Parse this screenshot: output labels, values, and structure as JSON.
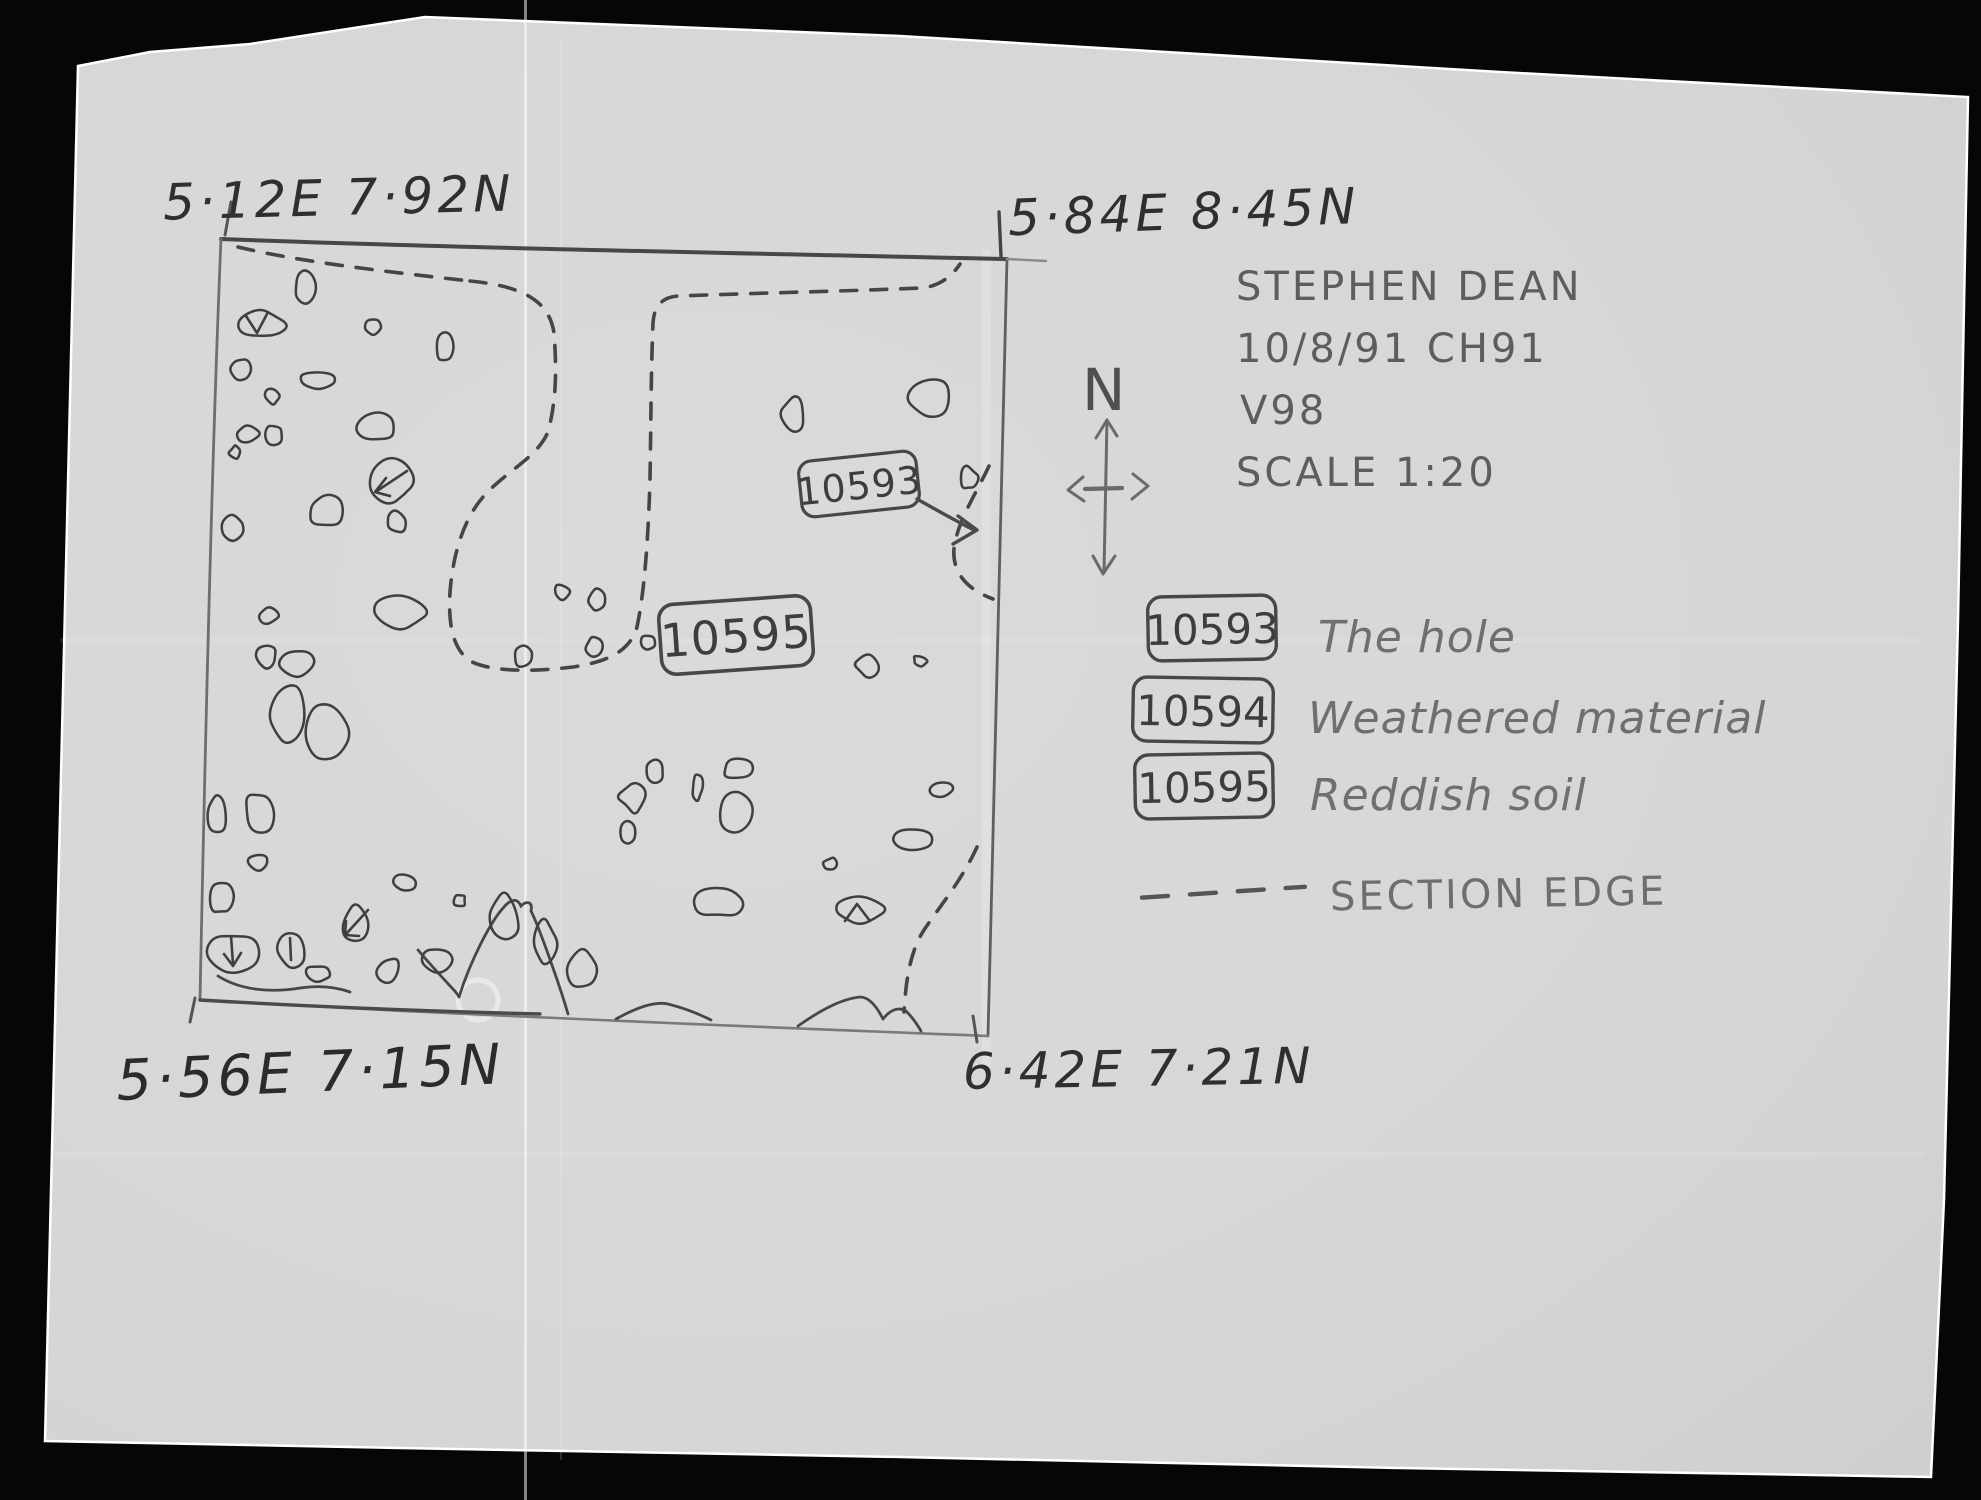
{
  "corner_coordinates": {
    "top_left": "5·12E 7·92N",
    "top_right": "5·84E 8·45N",
    "bottom_left": "5·56E 7·15N",
    "bottom_right": "6·42E 7·21N"
  },
  "title_block": {
    "recorder": "STEPHEN DEAN",
    "date_site": "10/8/91 CH91",
    "trench": "V98",
    "scale": "SCALE 1:20"
  },
  "north_arrow": {
    "label": "N"
  },
  "plan_labels": {
    "hole": "10593",
    "reddish_soil": "10595"
  },
  "legend": {
    "entries": [
      {
        "number": "10593",
        "description": "The hole"
      },
      {
        "number": "10594",
        "description": "Weathered material"
      },
      {
        "number": "10595",
        "description": "Reddish soil"
      }
    ],
    "section_edge": "SECTION EDGE"
  },
  "colors": {
    "background": "#060606",
    "paper": "#d7d7d5",
    "pencil_dark": "#3c3c3c",
    "pencil_mid": "#5d5d5d",
    "pencil_light": "#777777"
  }
}
